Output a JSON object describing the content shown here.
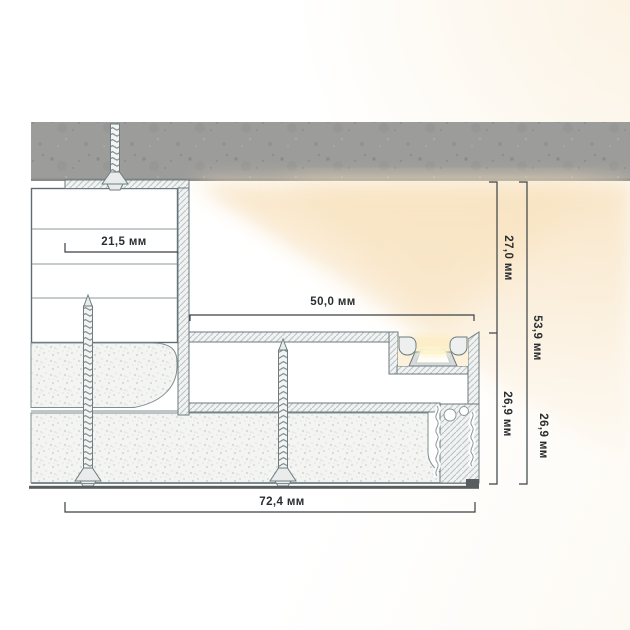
{
  "diagram": {
    "kind": "cross-section drawing",
    "dimensions": {
      "dim_21_5": "21,5 мм",
      "dim_50_0": "50,0 мм",
      "dim_27_0": "27,0 мм",
      "dim_53_9": "53,9 мм",
      "dim_26_9_inner": "26,9 мм",
      "dim_26_9_outer": "26,9 мм",
      "dim_72_4": "72,4 мм"
    },
    "colors": {
      "outline": "#6b7a7e",
      "dimension_line": "#3a4145",
      "dimension_text": "#2a2e31",
      "concrete_fill": "#9c9c9a",
      "hatch_fill": "#f1f2f2",
      "hatch_line": "#bcc3c5",
      "stipple_fill": "#f4f5f3",
      "warm_glow": "#f8e3c2",
      "led_light": "#fff6d2"
    }
  }
}
